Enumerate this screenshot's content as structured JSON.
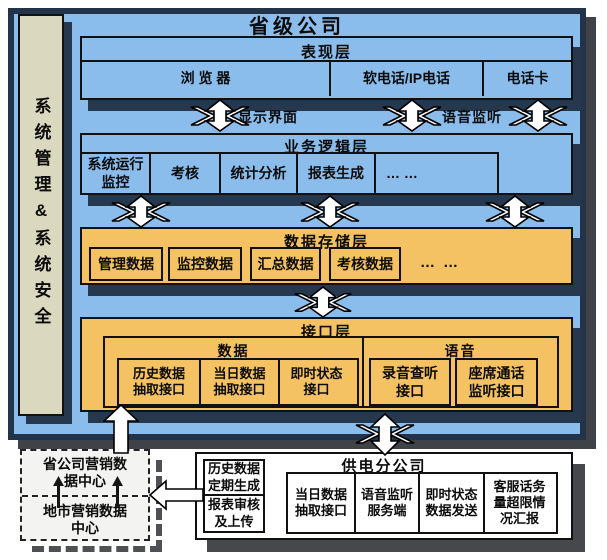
{
  "title": "省级公司",
  "sidebar": {
    "label": "系统管理&系统安全"
  },
  "presentation": {
    "title": "表现层",
    "cells": [
      "浏  览  器",
      "软电话/IP电话",
      "电话卡"
    ]
  },
  "flow_labels": {
    "display": "显示界面",
    "voice": "语音监听"
  },
  "business": {
    "title": "业务逻辑层",
    "cells": [
      "系统运行\n监控",
      "考核",
      "统计分析",
      "报表生成",
      "…  …"
    ]
  },
  "storage": {
    "title": "数据存储层",
    "items": [
      "管理数据",
      "监控数据",
      "汇总数据",
      "考核数据"
    ],
    "ellipsis": "…  …"
  },
  "interface": {
    "title": "接口层",
    "data_group": {
      "title": "数据",
      "cells": [
        "历史数据\n抽取接口",
        "当日数据\n抽取接口",
        "即时状态\n接口"
      ]
    },
    "voice_group": {
      "title": "语音",
      "cells": [
        "录音查听\n接口",
        "座席通话\n监听接口"
      ]
    }
  },
  "marketing": {
    "top": "省公司营销数\n据中心",
    "bottom": "地市营销数据\n中心"
  },
  "report_box": {
    "top": "历史数据\n定期生成",
    "bottom": "报表审核\n及上传"
  },
  "branch": {
    "title": "供电分公司",
    "cells": [
      "当日数据\n抽取接口",
      "语音监听\n服务端",
      "即时状态\n数据发送",
      "客服话务\n量超限情\n况汇报"
    ]
  },
  "colors": {
    "panel_blue": "#8ABCEC",
    "layer_orange": "#F5C263",
    "sidebar_beige": "#DBD8C0",
    "frame_navy": "#22334A",
    "shadow_navy": "#26384D",
    "shadow_gray": "#47484B"
  }
}
